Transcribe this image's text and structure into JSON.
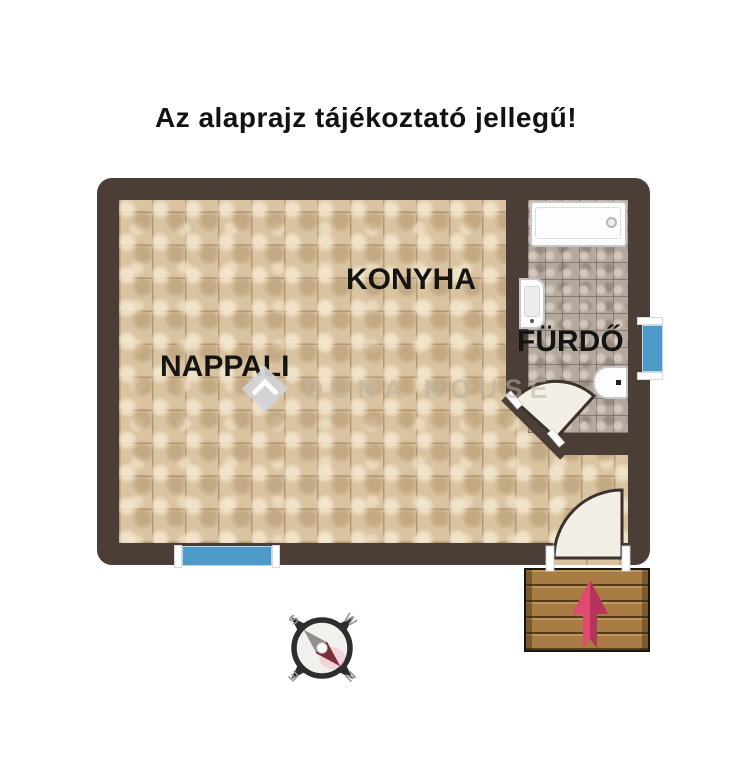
{
  "title": "Az alaprajz tájékoztató jellegű!",
  "floorplan": {
    "rooms": {
      "nappali": {
        "label": "NAPPALI"
      },
      "konyha": {
        "label": "KONYHA"
      },
      "furdo": {
        "label": "FÜRDŐ"
      }
    },
    "fixtures": [
      "bathtub",
      "washbasin",
      "toilet",
      "bathroom-door",
      "entrance-door",
      "window-south",
      "window-east",
      "entrance-steps",
      "direction-arrow"
    ],
    "colors": {
      "wall": "#4a3e36",
      "floor_tile": "#d9c3a1",
      "floor_grout": "#927650",
      "bath_tile": "#b5a99d",
      "bath_grout": "#7d7266",
      "window": "#4d9ac9",
      "wood": "#a87c44",
      "arrow": "#df4a70",
      "door_swing": "#f3efe6"
    }
  },
  "watermark": {
    "text": "DUNA HOUSE"
  },
  "compass": {
    "south": "S",
    "west": "W",
    "east": "E",
    "north": "N"
  }
}
